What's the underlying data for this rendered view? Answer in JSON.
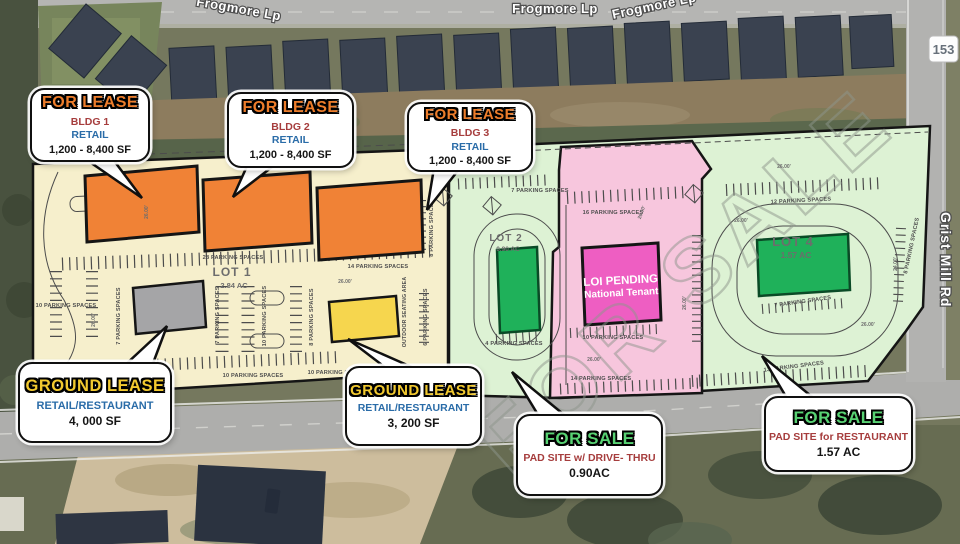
{
  "streets": {
    "frogmore_top_left": "Frogmore Lp",
    "frogmore_top_center": "Frogmore Lp",
    "frogmore_top_right": "Frogmore Lp",
    "grist_mill_road": "Grist Mill Rd",
    "route_marker": "153"
  },
  "watermark": "FOR SALE",
  "lots": {
    "lot1": {
      "name": "LOT 1",
      "area": "2.84 AC"
    },
    "lot2": {
      "name": "LOT 2",
      "area": "0.90 AC"
    },
    "lot4": {
      "name": "LOT 4",
      "area": "1.57 AC"
    }
  },
  "loi_building": {
    "line1": "LOI PENDING",
    "line2": "National Tenant"
  },
  "outdoor_seating": "OUTDOOR SEATING AREA",
  "parking_labels": [
    "28 PARKING SPACES",
    "14 PARKING SPACES",
    "10 PARKING SPACES",
    "7 PARKING SPACES",
    "7 PARKING SPACES",
    "10 PARKING SPACES",
    "8 PARKING SPACES",
    "6 PARKING SPACES",
    "8 PARKING SPACES",
    "10 PARKING SPACES",
    "10 PARKING SPACES",
    "7 PARKING SPACES",
    "4 PARKING SPACES",
    "16 PARKING SPACES",
    "10 PARKING SPACES",
    "14 PARKING SPACES",
    "12 PARKING SPACES",
    "8 PARKING SPACES",
    "7 PARKING SPACES",
    "13 PARKING SPACES"
  ],
  "dimension_labels": [
    "26.00'",
    "26.00'",
    "26.00'",
    "26.00'",
    "26.00'",
    "26.00'",
    "26.00'",
    "26.00'",
    "24.00'",
    "26.00'"
  ],
  "callouts": [
    {
      "title": "FOR LEASE",
      "lines": [
        "BLDG 1",
        "RETAIL",
        "1,200 - 8,400 SF"
      ]
    },
    {
      "title": "FOR LEASE",
      "lines": [
        "BLDG 2",
        "RETAIL",
        "1,200 - 8,400 SF"
      ]
    },
    {
      "title": "FOR LEASE",
      "lines": [
        "BLDG 3",
        "RETAIL",
        "1,200 - 8,400 SF"
      ]
    },
    {
      "title": "GROUND LEASE",
      "lines": [
        "RETAIL/RESTAURANT",
        "4, 000 SF"
      ]
    },
    {
      "title": "GROUND LEASE",
      "lines": [
        "RETAIL/RESTAURANT",
        "3, 200 SF"
      ]
    },
    {
      "title": "FOR SALE",
      "lines": [
        "PAD SITE w/ DRIVE- THRU",
        "0.90AC"
      ]
    },
    {
      "title": "FOR SALE",
      "lines": [
        "PAD SITE for RESTAURANT",
        "1.57 AC"
      ]
    }
  ],
  "colors": {
    "lot1_fill": "#f6efcc",
    "lot_green_fill": "#ddf2d4",
    "lot_pink_fill": "#f7c6dd",
    "building_orange": "#f08236",
    "building_green": "#1fb15a",
    "building_magenta": "#ee5ec2",
    "building_gray": "#a5a5a7",
    "building_yellow": "#f6d64e",
    "for_lease_text": "#ed7d2b",
    "ground_lease_text": "#f2c92f",
    "for_sale_text": "#58d273",
    "detail_red": "#a63d3d",
    "detail_blue": "#2a6ca8"
  }
}
